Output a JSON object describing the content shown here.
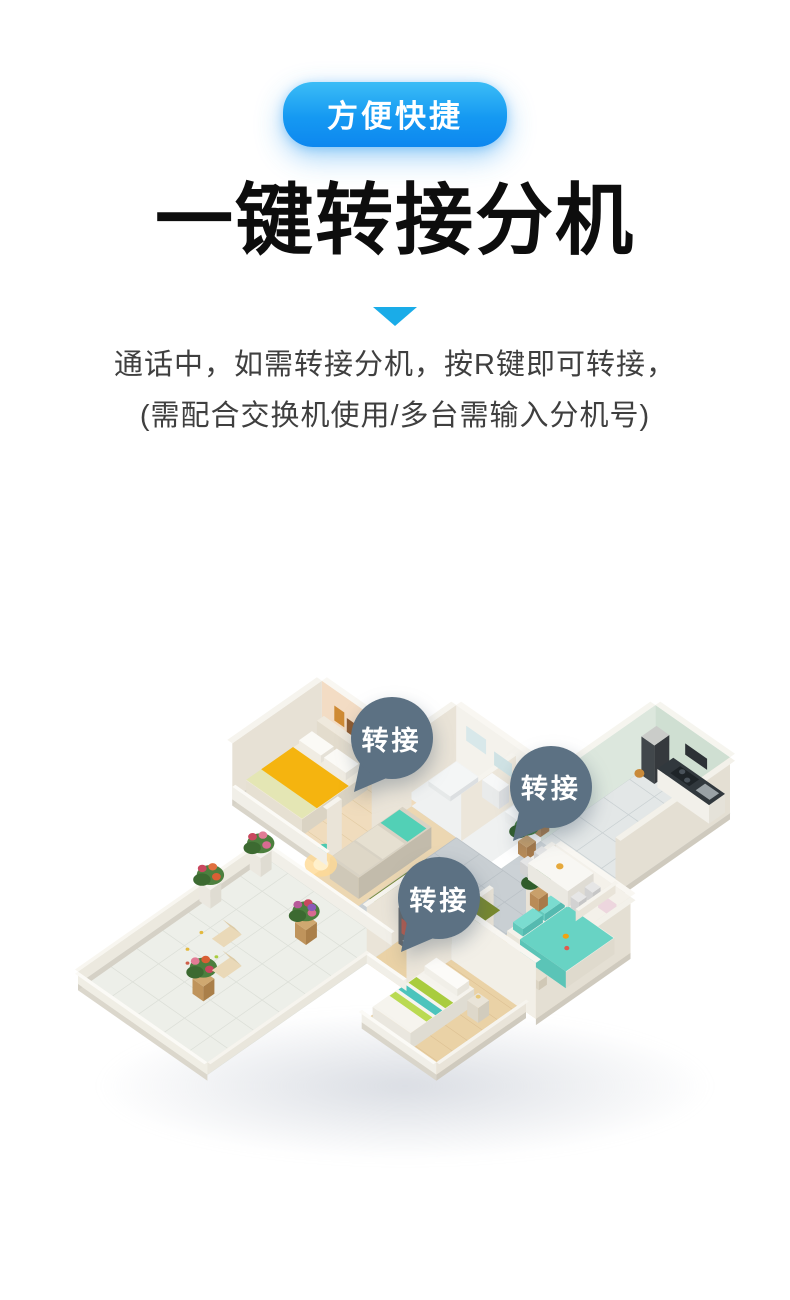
{
  "header": {
    "tag": "方便快捷",
    "title": "一键转接分机",
    "desc_line1": "通话中，如需转接分机，按R键即可转接，",
    "desc_line2": "(需配合交换机使用/多台需输入分机号)",
    "tag_gradient_top": "#3bbdf6",
    "tag_gradient_bottom": "#0d87ef",
    "triangle_color": "#1aace8",
    "title_color": "#0d0d0d",
    "desc_color": "#3f3f3f"
  },
  "floorplan": {
    "description": "3D isometric cutaway apartment floor plan with transfer markers",
    "badge_color": "#5c7183",
    "badges": [
      {
        "label": "转接",
        "room": "bedroom-1"
      },
      {
        "label": "转接",
        "room": "dining-kitchen"
      },
      {
        "label": "转接",
        "room": "bedroom-3"
      }
    ]
  }
}
